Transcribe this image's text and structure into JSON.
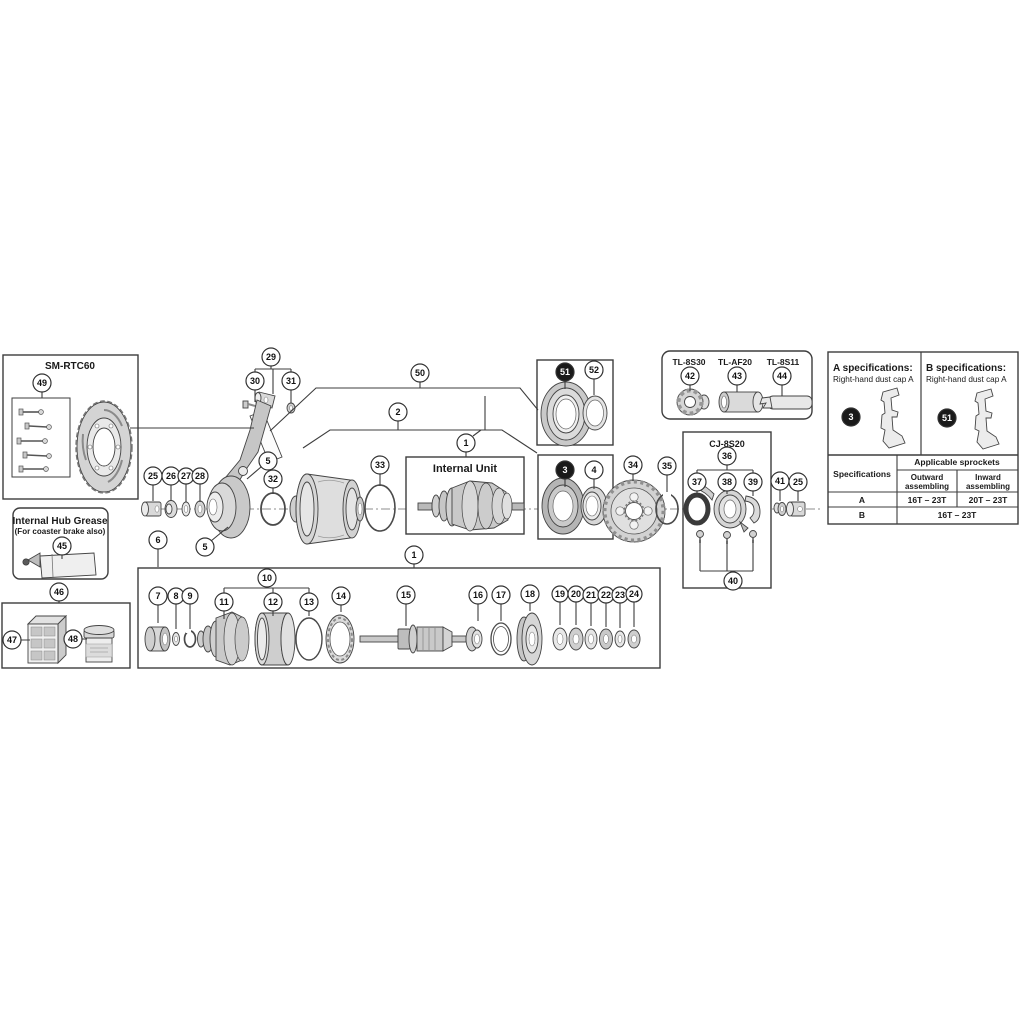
{
  "figure": {
    "boxes": {
      "rotor_kit": {
        "label": "SM-RTC60"
      },
      "grease_tube": {
        "title": "Internal Hub Grease",
        "subtitle": "(For coaster brake also)"
      },
      "internal_unit": {
        "label": "Internal Unit"
      },
      "cassette_joint": {
        "label": "CJ-8S20"
      },
      "tools": {
        "labels": [
          "TL-8S30",
          "TL-AF20",
          "TL-8S11"
        ]
      }
    },
    "spec_panel": {
      "a": {
        "title": "A specifications:",
        "subtitle": "Right-hand dust cap A"
      },
      "b": {
        "title": "B specifications:",
        "subtitle": "Right-hand dust cap A"
      },
      "table": {
        "row_header": "Specifications",
        "group_header": "Applicable sprockets",
        "col1_line1": "Outward",
        "col1_line2": "assembling",
        "col2_line1": "Inward",
        "col2_line2": "assembling",
        "rows": [
          {
            "spec": "A",
            "outward": "16T – 23T",
            "inward": "20T – 23T"
          },
          {
            "spec": "B",
            "both": "16T – 23T"
          }
        ]
      }
    },
    "callouts": [
      {
        "n": "49",
        "x": 42,
        "y": 383
      },
      {
        "n": "45",
        "x": 62,
        "y": 546
      },
      {
        "n": "46",
        "x": 59,
        "y": 592
      },
      {
        "n": "47",
        "x": 12,
        "y": 640
      },
      {
        "n": "48",
        "x": 73,
        "y": 639
      },
      {
        "n": "29",
        "x": 271,
        "y": 357
      },
      {
        "n": "30",
        "x": 255,
        "y": 381
      },
      {
        "n": "31",
        "x": 291,
        "y": 381
      },
      {
        "n": "50",
        "x": 420,
        "y": 373
      },
      {
        "n": "2",
        "x": 398,
        "y": 412
      },
      {
        "n": "1",
        "x": 466,
        "y": 443
      },
      {
        "n": "51",
        "x": 565,
        "y": 372,
        "filled": true
      },
      {
        "n": "52",
        "x": 594,
        "y": 370
      },
      {
        "n": "25",
        "x": 153,
        "y": 476
      },
      {
        "n": "26",
        "x": 171,
        "y": 476
      },
      {
        "n": "27",
        "x": 186,
        "y": 476,
        "r": 8
      },
      {
        "n": "28",
        "x": 200,
        "y": 476,
        "r": 8
      },
      {
        "n": "5",
        "x": 268,
        "y": 461
      },
      {
        "n": "32",
        "x": 273,
        "y": 479
      },
      {
        "n": "33",
        "x": 380,
        "y": 465
      },
      {
        "n": "3",
        "x": 565,
        "y": 470,
        "filled": true
      },
      {
        "n": "4",
        "x": 594,
        "y": 470
      },
      {
        "n": "34",
        "x": 633,
        "y": 465
      },
      {
        "n": "35",
        "x": 667,
        "y": 466
      },
      {
        "n": "42",
        "x": 690,
        "y": 376
      },
      {
        "n": "43",
        "x": 737,
        "y": 376
      },
      {
        "n": "44",
        "x": 782,
        "y": 376
      },
      {
        "n": "36",
        "x": 727,
        "y": 456
      },
      {
        "n": "37",
        "x": 697,
        "y": 482
      },
      {
        "n": "38",
        "x": 727,
        "y": 482
      },
      {
        "n": "39",
        "x": 753,
        "y": 482
      },
      {
        "n": "40",
        "x": 733,
        "y": 581
      },
      {
        "n": "41",
        "x": 780,
        "y": 481
      },
      {
        "n": "25",
        "x": 798,
        "y": 482
      },
      {
        "n": "3",
        "x": 851,
        "y": 417,
        "filled": true
      },
      {
        "n": "51",
        "x": 947,
        "y": 418,
        "filled": true
      },
      {
        "n": "6",
        "x": 158,
        "y": 540
      },
      {
        "n": "5",
        "x": 205,
        "y": 547
      },
      {
        "n": "1",
        "x": 414,
        "y": 555
      },
      {
        "n": "7",
        "x": 158,
        "y": 596
      },
      {
        "n": "8",
        "x": 176,
        "y": 596,
        "r": 8
      },
      {
        "n": "9",
        "x": 190,
        "y": 596,
        "r": 8
      },
      {
        "n": "10",
        "x": 267,
        "y": 578
      },
      {
        "n": "11",
        "x": 224,
        "y": 602
      },
      {
        "n": "12",
        "x": 273,
        "y": 602
      },
      {
        "n": "13",
        "x": 309,
        "y": 602
      },
      {
        "n": "14",
        "x": 341,
        "y": 596
      },
      {
        "n": "15",
        "x": 406,
        "y": 595
      },
      {
        "n": "16",
        "x": 478,
        "y": 595
      },
      {
        "n": "17",
        "x": 501,
        "y": 595
      },
      {
        "n": "18",
        "x": 530,
        "y": 594
      },
      {
        "n": "19",
        "x": 560,
        "y": 594,
        "r": 8
      },
      {
        "n": "20",
        "x": 576,
        "y": 594,
        "r": 8
      },
      {
        "n": "21",
        "x": 591,
        "y": 595,
        "r": 8
      },
      {
        "n": "22",
        "x": 606,
        "y": 595,
        "r": 8
      },
      {
        "n": "23",
        "x": 620,
        "y": 595,
        "r": 8
      },
      {
        "n": "24",
        "x": 634,
        "y": 594,
        "r": 8
      }
    ]
  }
}
